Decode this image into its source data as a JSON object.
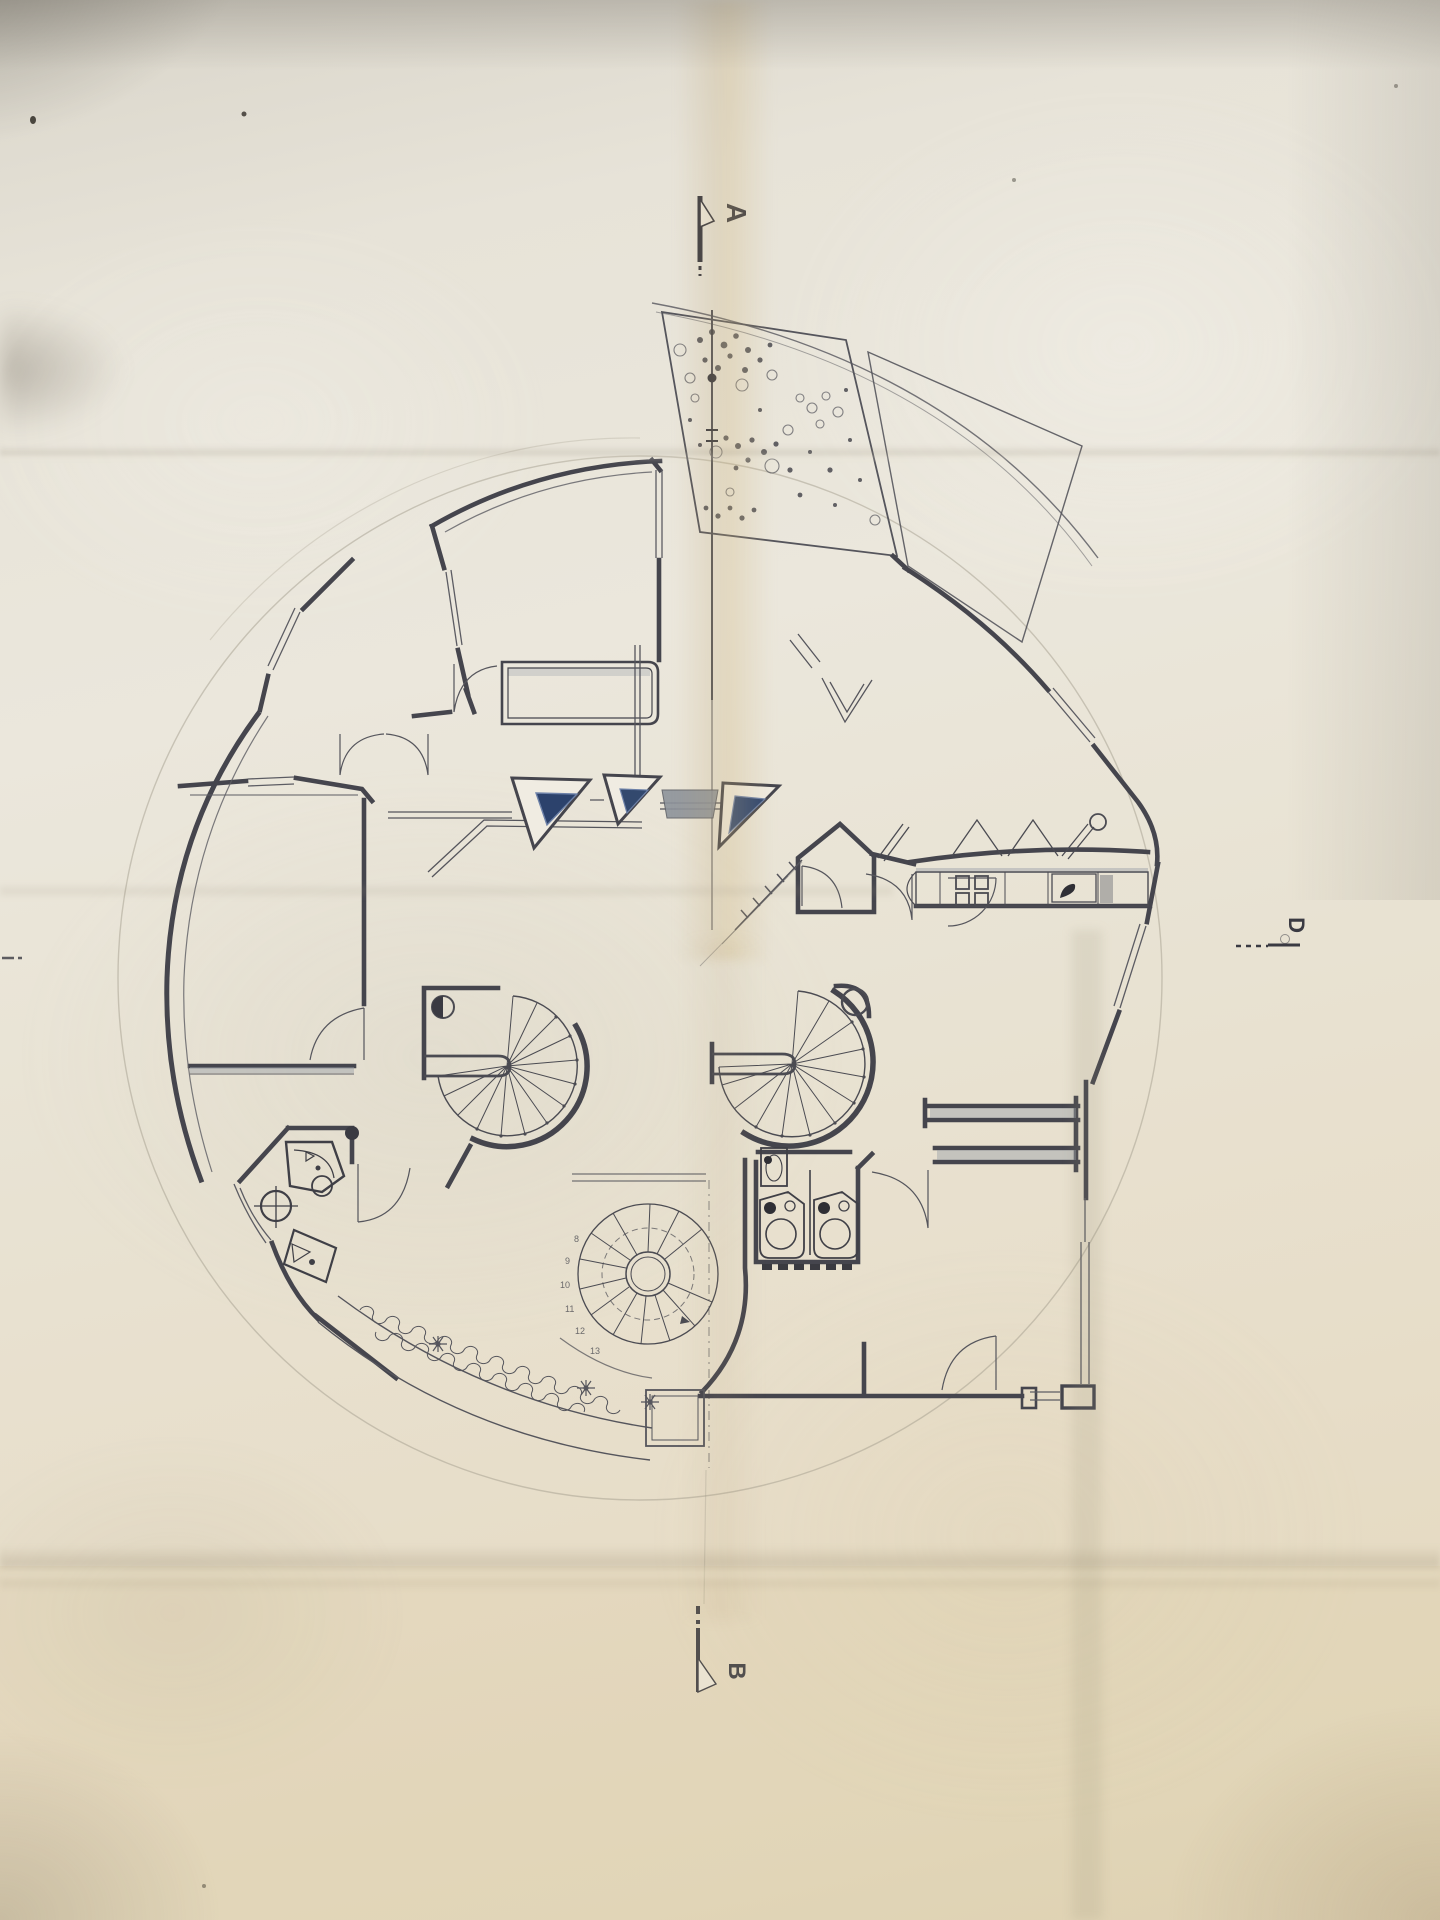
{
  "section_markers": {
    "a": "A",
    "b": "B",
    "d": "D"
  },
  "stair_tread_numbers": [
    "8",
    "9",
    "10",
    "11",
    "12",
    "13"
  ],
  "colors": {
    "paper_light": "#ece8dd",
    "paper_tan": "#e4d9bf",
    "crease_tan": "#cdb88e",
    "ink_wall": "#45454d",
    "ink_thin": "#5c5c63",
    "pencil": "#a49e8e",
    "skylight_glazing_dark": "#2c426c",
    "skylight_glazing_light": "#6d81a8",
    "grey_fill": "#99a0a8",
    "fixture_black": "#2f2f35"
  }
}
